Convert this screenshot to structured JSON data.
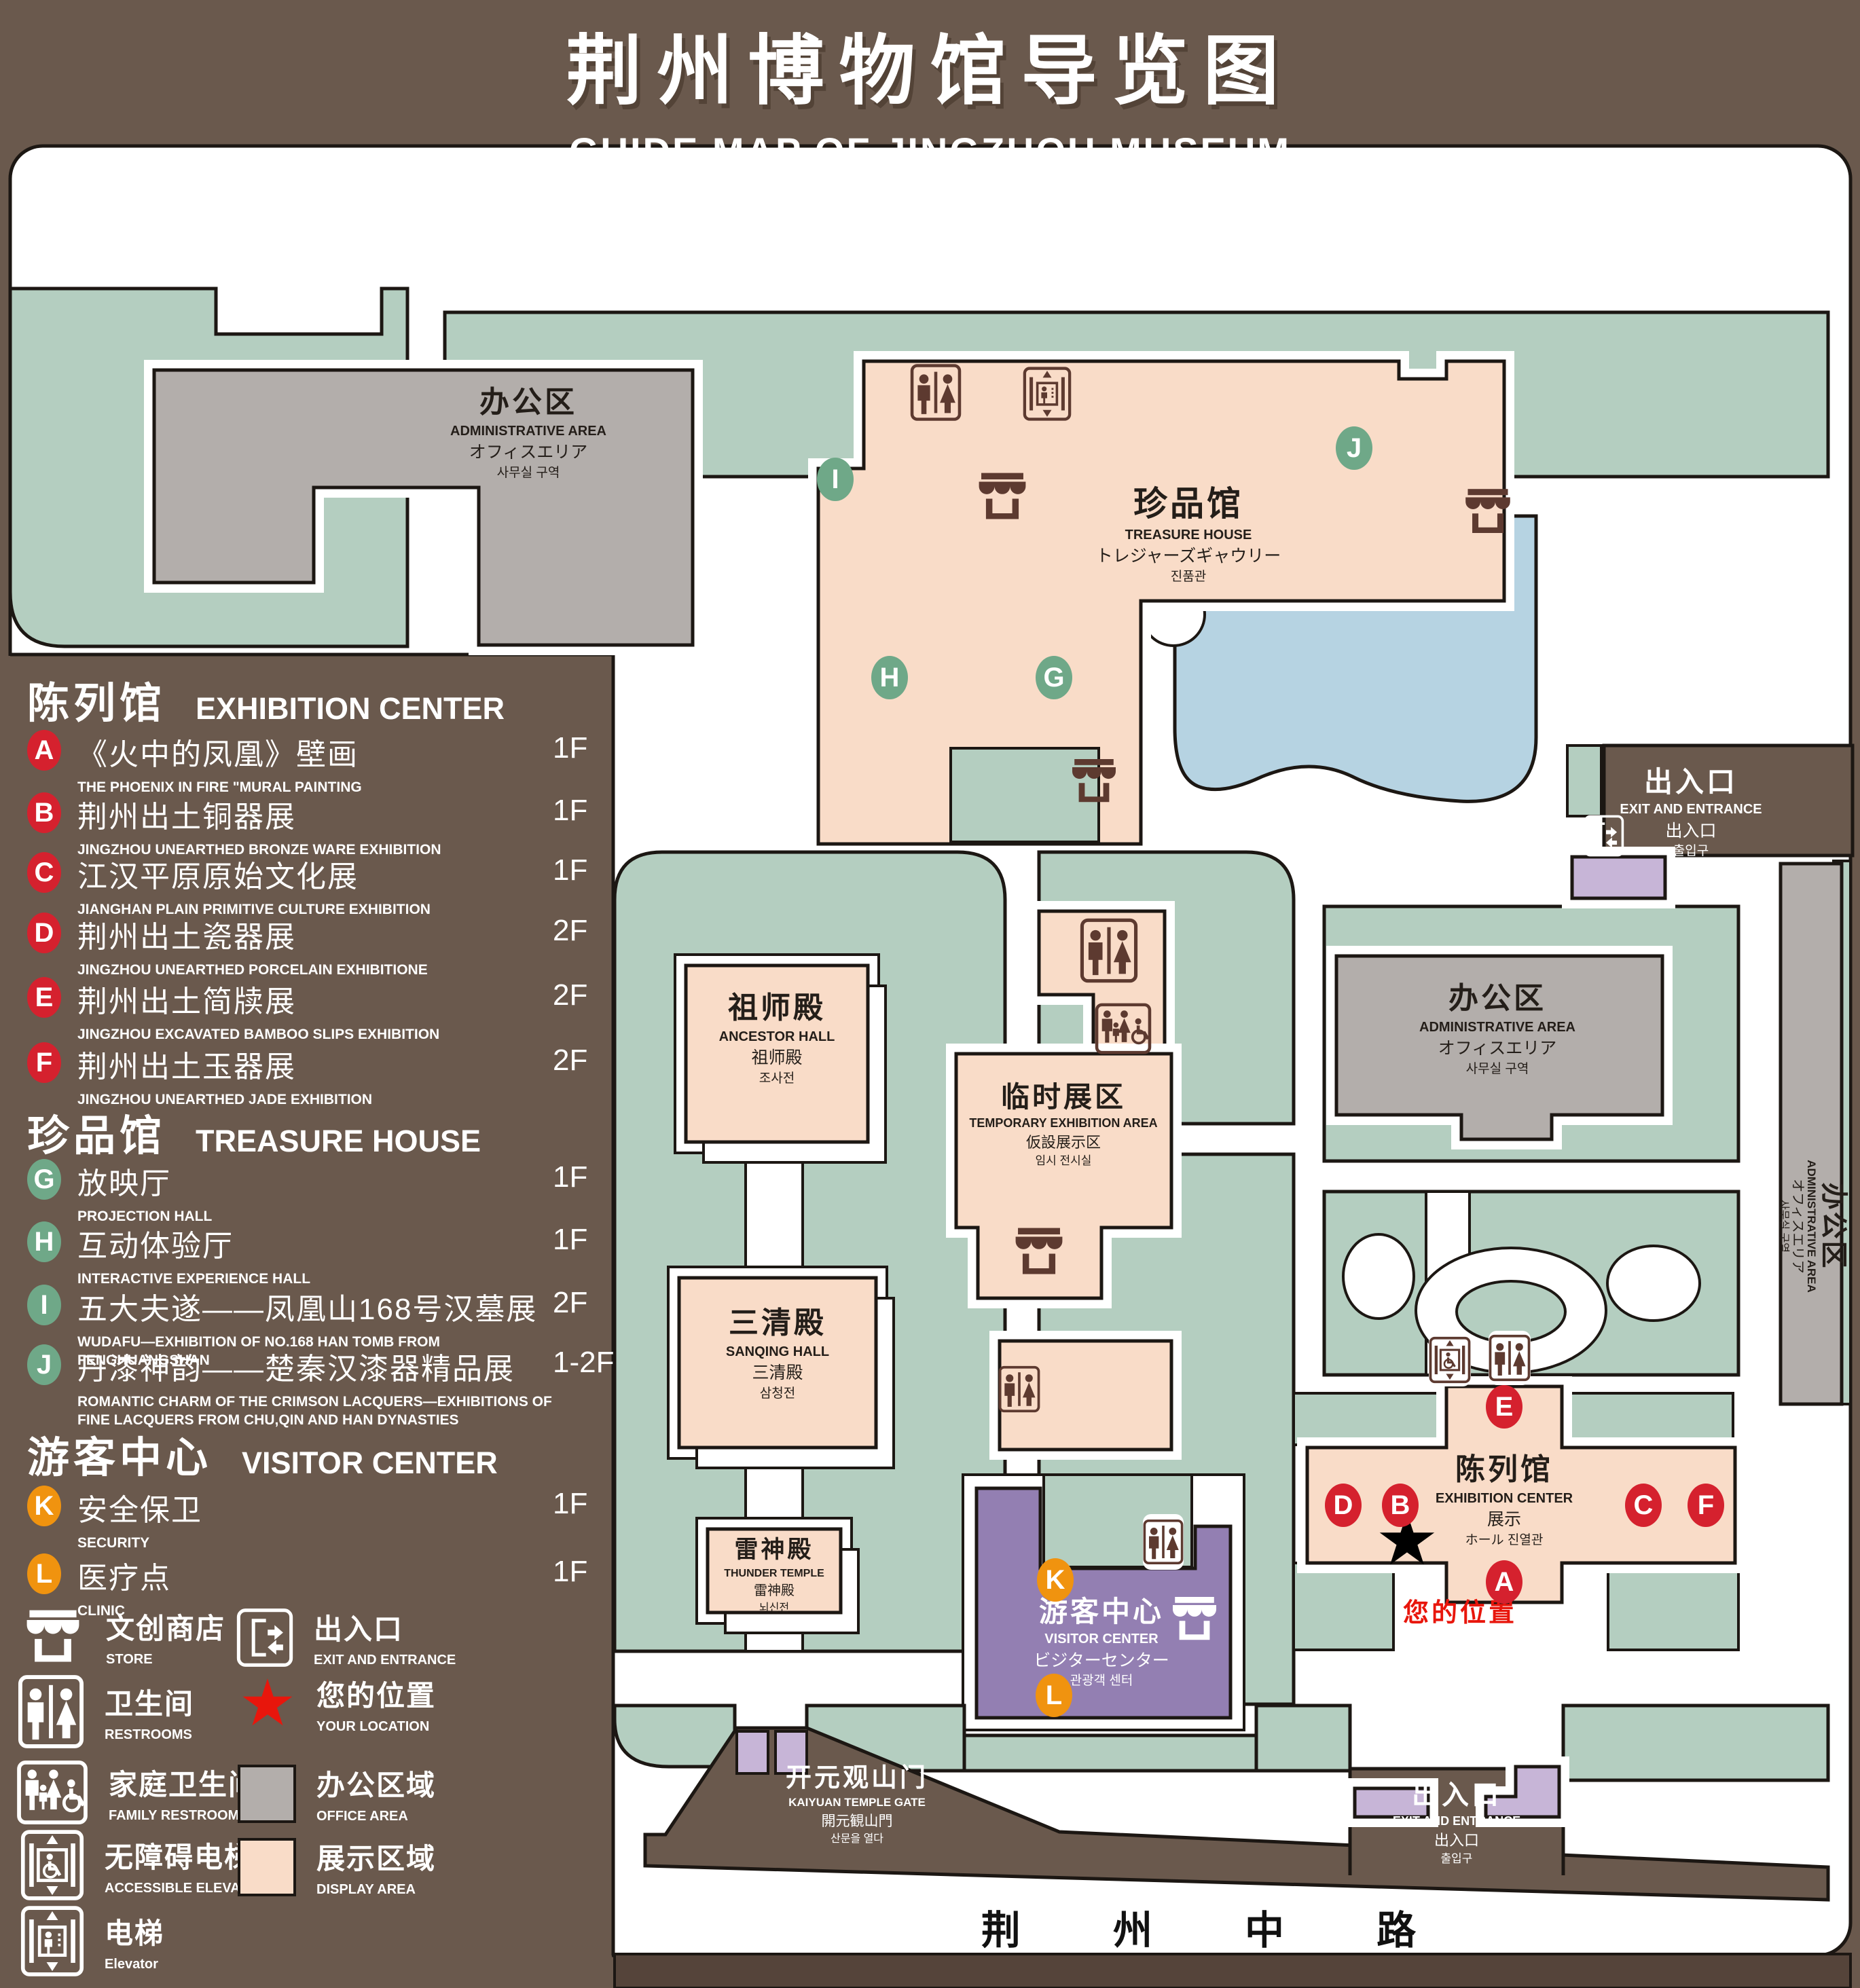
{
  "title": {
    "zh": "荆州博物馆导览图",
    "en": "GUIDE MAP OF JINGZHOU MUSEUM"
  },
  "colors": {
    "background": "#6a594d",
    "display_area": "#f9dcc8",
    "office_area": "#b3aeab",
    "green_space": "#b4cec0",
    "water": "#b6d3e2",
    "visitor_center_purple": "#937fb2",
    "badge_red": "#d5212e",
    "badge_green": "#6fa888",
    "badge_orange": "#f0930f",
    "location_red": "#e8160c"
  },
  "legend": {
    "sections": [
      {
        "title_zh": "陈列馆",
        "title_en": "EXHIBITION CENTER",
        "items": [
          {
            "letter": "A",
            "zh": "《火中的凤凰》壁画",
            "en": "THE PHOENIX IN FIRE \"MURAL PAINTING",
            "floor": "1F"
          },
          {
            "letter": "B",
            "zh": "荆州出土铜器展",
            "en": "JINGZHOU UNEARTHED BRONZE WARE EXHIBITION",
            "floor": "1F"
          },
          {
            "letter": "C",
            "zh": "江汉平原原始文化展",
            "en": "JIANGHAN PLAIN PRIMITIVE CULTURE EXHIBITION",
            "floor": "1F"
          },
          {
            "letter": "D",
            "zh": "荆州出土瓷器展",
            "en": "JINGZHOU UNEARTHED PORCELAIN EXHIBITIONE",
            "floor": "2F"
          },
          {
            "letter": "E",
            "zh": "荆州出土简牍展",
            "en": "JINGZHOU EXCAVATED BAMBOO SLIPS EXHIBITION",
            "floor": "2F"
          },
          {
            "letter": "F",
            "zh": "荆州出土玉器展",
            "en": "JINGZHOU UNEARTHED JADE EXHIBITION",
            "floor": "2F"
          }
        ]
      },
      {
        "title_zh": "珍品馆",
        "title_en": "TREASURE HOUSE",
        "items": [
          {
            "letter": "G",
            "zh": "放映厅",
            "en": "PROJECTION HALL",
            "floor": "1F"
          },
          {
            "letter": "H",
            "zh": "互动体验厅",
            "en": "INTERACTIVE EXPERIENCE HALL",
            "floor": "1F"
          },
          {
            "letter": "I",
            "zh": "五大夫遂——凤凰山168号汉墓展",
            "en": "WUDAFU—EXHIBITION OF NO.168 HAN TOMB FROM FENGHUANGSHAN",
            "floor": "2F"
          },
          {
            "letter": "J",
            "zh": "丹漆神韵——楚秦汉漆器精品展",
            "en": "ROMANTIC CHARM OF THE CRIMSON LACQUERS—EXHIBITIONS OF FINE LACQUERS FROM CHU,QIN AND HAN DYNASTIES",
            "floor": "1-2F"
          }
        ]
      },
      {
        "title_zh": "游客中心",
        "title_en": "VISITOR CENTER",
        "items": [
          {
            "letter": "K",
            "zh": "安全保卫",
            "en": "SECURITY",
            "floor": "1F"
          },
          {
            "letter": "L",
            "zh": "医疗点",
            "en": "CLINIC",
            "floor": "1F"
          }
        ]
      }
    ],
    "symbols": [
      {
        "icon": "store-icon",
        "zh": "文创商店",
        "en": "STORE"
      },
      {
        "icon": "restrooms-icon",
        "zh": "卫生间",
        "en": "RESTROOMS"
      },
      {
        "icon": "family-restrooms-icon",
        "zh": "家庭卫生间",
        "en": "FAMILY RESTROOMS"
      },
      {
        "icon": "accessible-elevator-icon",
        "zh": "无障碍电梯",
        "en": "ACCESSIBLE ELEVATOR"
      },
      {
        "icon": "elevator-icon",
        "zh": "电梯",
        "en": "Elevator"
      },
      {
        "icon": "exit-entrance-icon",
        "zh": "出入口",
        "en": "EXIT AND ENTRANCE"
      },
      {
        "icon": "your-location-star",
        "zh": "您的位置",
        "en": "YOUR LOCATION"
      },
      {
        "icon": "office-area-swatch",
        "zh": "办公区域",
        "en": "OFFICE AREA"
      },
      {
        "icon": "display-area-swatch",
        "zh": "展示区域",
        "en": "DISPLAY AREA"
      }
    ]
  },
  "map": {
    "labels": {
      "admin": {
        "zh": "办公区",
        "en": "ADMINISTRATIVE AREA",
        "jp": "オフィスエリア",
        "kr": "사무실 구역"
      },
      "treasure": {
        "zh": "珍品馆",
        "en": "TREASURE HOUSE",
        "jp": "トレジャーズギャウリー",
        "kr": "진품관"
      },
      "ancestor": {
        "zh": "祖师殿",
        "en": "ANCESTOR HALL",
        "jp": "祖师殿",
        "kr": "조사전"
      },
      "sanqing": {
        "zh": "三清殿",
        "en": "SANQING HALL",
        "jp": "三清殿",
        "kr": "삼청전"
      },
      "thunder": {
        "zh": "雷神殿",
        "en": "THUNDER TEMPLE",
        "jp": "雷神殿",
        "kr": "뇌신전"
      },
      "temporary": {
        "zh": "临时展区",
        "en": "TEMPORARY EXHIBITION AREA",
        "jp": "仮設展示区",
        "kr": "임시 전시실"
      },
      "visitor": {
        "zh": "游客中心",
        "en": "VISITOR CENTER",
        "jp": "ビジターセンター",
        "kr": "관광객 센터"
      },
      "exhibition": {
        "zh": "陈列馆",
        "en": "EXHIBITION CENTER",
        "jp": "展示",
        "kr": "ホール 진열관"
      },
      "exit": {
        "zh": "出入口",
        "en": "EXIT AND ENTRANCE",
        "jp": "出入口",
        "kr": "출입구"
      },
      "gate": {
        "zh": "开元观山门",
        "en": "KAIYUAN TEMPLE GATE",
        "jp": "開元観山門",
        "kr": "산문을 열다"
      },
      "road": "荆 州 中 路",
      "you": "您的位置",
      "star": "★"
    },
    "badges": {
      "a": "A",
      "b": "B",
      "c": "C",
      "d": "D",
      "e": "E",
      "f": "F",
      "g": "G",
      "h": "H",
      "i": "I",
      "j": "J",
      "k": "K",
      "l": "L"
    }
  }
}
